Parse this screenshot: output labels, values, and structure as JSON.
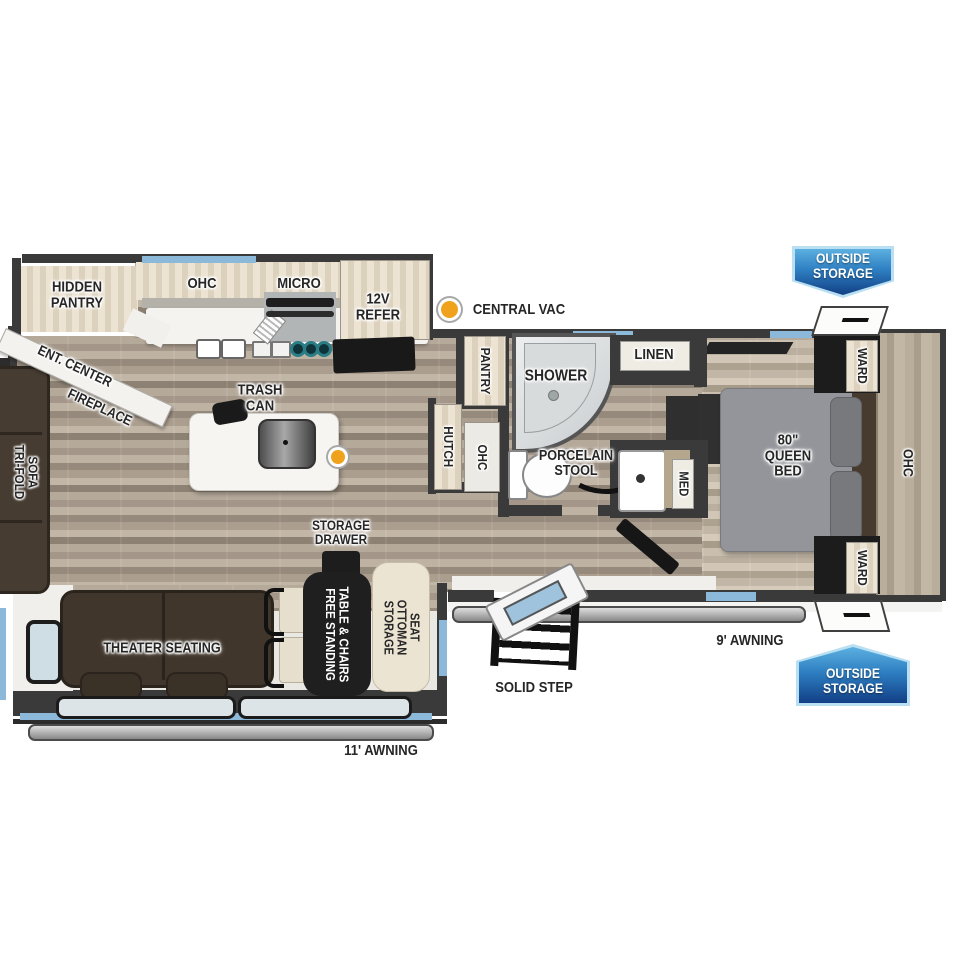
{
  "colors": {
    "badge_blue_light": "#5cb0e0",
    "badge_blue_dark": "#123f85",
    "badge_border": "#b9dff2",
    "window_accent": "#8cb8da",
    "vac_dot": "#f0a21c",
    "wall": "#3a3a3a"
  },
  "legend": {
    "central_vac": "CENTRAL VAC"
  },
  "exterior": {
    "outside_storage_top": {
      "lines": [
        "OUTSIDE",
        "STORAGE"
      ]
    },
    "outside_storage_bottom": {
      "lines": [
        "OUTSIDE",
        "STORAGE"
      ]
    },
    "awning_front": "9' AWNING",
    "awning_rear": "11' AWNING",
    "solid_step": "SOLID STEP"
  },
  "kitchen": {
    "hidden_pantry": {
      "lines": [
        "HIDDEN",
        "PANTRY"
      ]
    },
    "ohc": "OHC",
    "micro": "MICRO",
    "refer": {
      "lines": [
        "12V",
        "REFER"
      ]
    },
    "trash_can": {
      "lines": [
        "TRASH",
        "CAN"
      ]
    },
    "ent_center": "ENT. CENTER",
    "fireplace": "FIREPLACE"
  },
  "living": {
    "tri_fold_sofa": {
      "lines": [
        "TRI-FOLD",
        "SOFA"
      ]
    },
    "theater_seating": "THEATER SEATING",
    "storage_drawer": {
      "lines": [
        "STORAGE",
        "DRAWER"
      ]
    },
    "table_chairs": {
      "lines": [
        "FREE STANDING",
        "TABLE & CHAIRS"
      ]
    },
    "storage_ottoman": {
      "lines": [
        "STORAGE",
        "OTTOMAN",
        "SEAT"
      ]
    }
  },
  "hallway": {
    "pantry": "PANTRY",
    "hutch": "HUTCH",
    "ohc": "OHC"
  },
  "bathroom": {
    "shower": "SHOWER",
    "linen": "LINEN",
    "porcelain_stool": {
      "lines": [
        "PORCELAIN",
        "STOOL"
      ]
    },
    "med": "MED"
  },
  "bedroom": {
    "queen_bed": {
      "lines": [
        "80\"",
        "QUEEN",
        "BED"
      ]
    },
    "ward_top": "WARD",
    "ward_bottom": "WARD",
    "ohc": "OHC"
  }
}
